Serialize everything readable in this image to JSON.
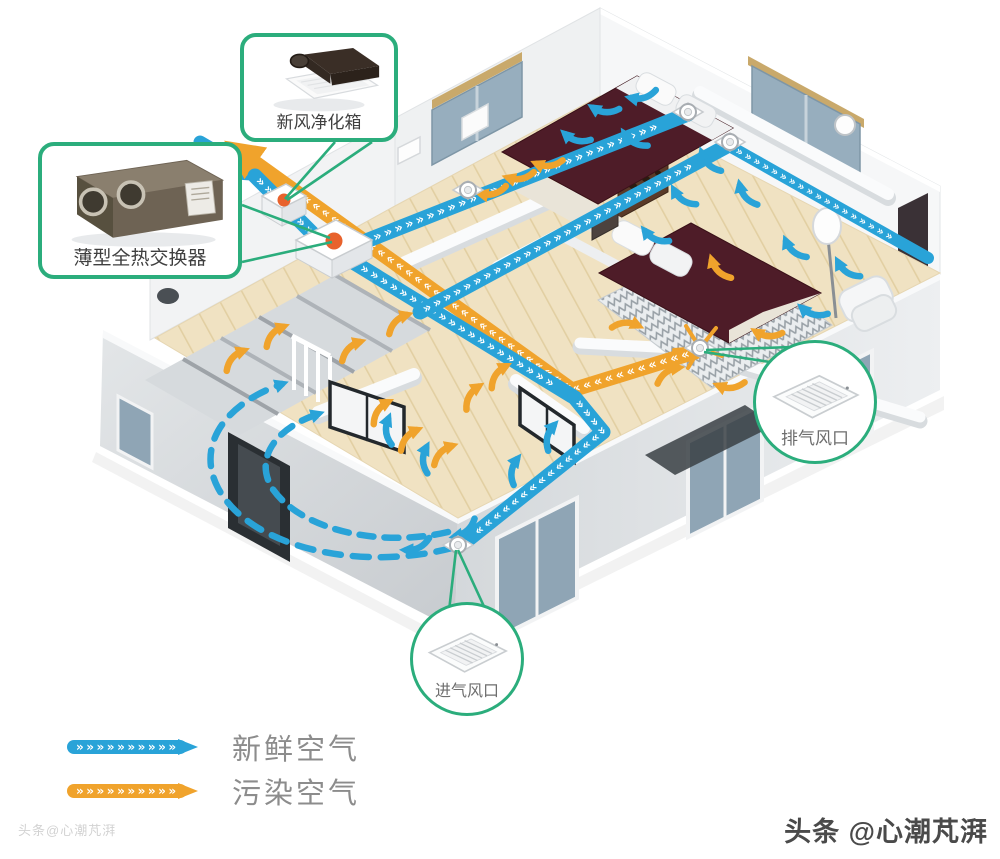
{
  "callouts": {
    "purifier_box": {
      "label": "新风净化箱",
      "icon": "ceiling-fan-unit"
    },
    "heat_exchanger": {
      "label": "薄型全热交换器",
      "icon": "heat-exchanger-unit"
    },
    "exhaust_vent": {
      "label": "排气风口",
      "icon": "ceiling-vent-grille"
    },
    "intake_vent": {
      "label": "进气风口",
      "icon": "ceiling-vent-grille"
    }
  },
  "legend": {
    "items": [
      {
        "label": "新鲜空气",
        "color": "#29A3D8",
        "meaning": "fresh air"
      },
      {
        "label": "污染空气",
        "color": "#F0A32C",
        "meaning": "polluted air"
      }
    ]
  },
  "watermarks": {
    "bottom_right": "头条 @心潮芃湃",
    "bottom_left_faint": "头条@心潮芃湃"
  },
  "colors": {
    "fresh_air_blue": "#29A3D8",
    "polluted_air_orange": "#F0A32C",
    "callout_green": "#2BAD7C",
    "unit_marker_orange": "#E8622C",
    "bed_maroon": "#4E1C28"
  }
}
